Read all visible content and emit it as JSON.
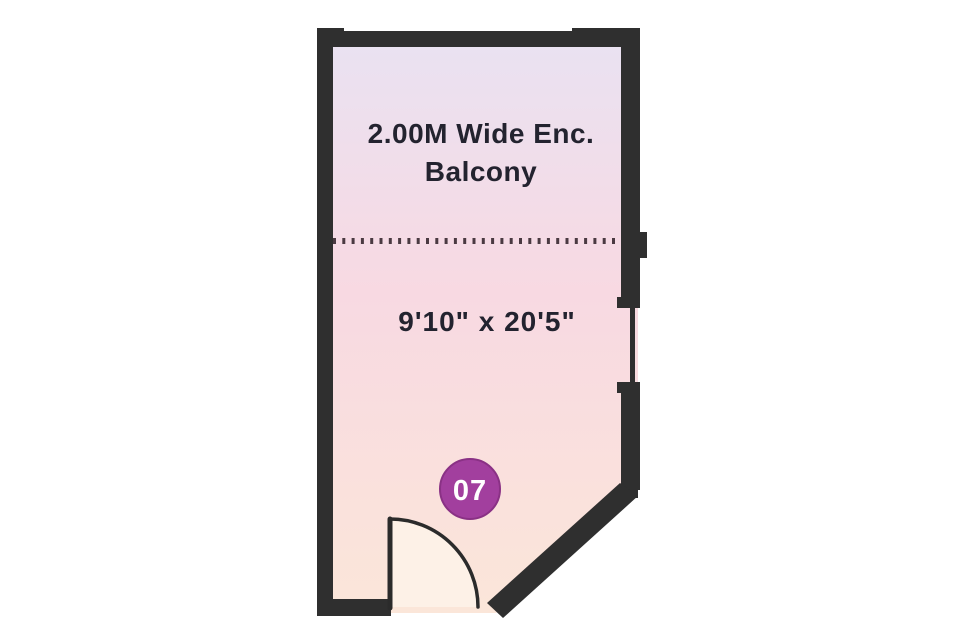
{
  "floor_plan": {
    "balcony_label": {
      "line1": "2.00M Wide Enc.",
      "line2": "Balcony"
    },
    "dimensions_label": "9'10\" x 20'5\"",
    "unit_badge": {
      "number": "07"
    },
    "colors": {
      "wall": "#2f2f2f",
      "door_line": "#2b2b2b",
      "badge_fill": "#a23f9e",
      "badge_ring": "#8a3185",
      "badge_text": "#ffffff",
      "label_text": "#23232f",
      "room_gradient_top": "#e9e2f2",
      "room_gradient_mid": "#f8d9e2",
      "room_gradient_bottom": "#fbe6d9",
      "door_swing_fill": "#fdf1e7",
      "partition_dots": "#4a3a42"
    }
  }
}
